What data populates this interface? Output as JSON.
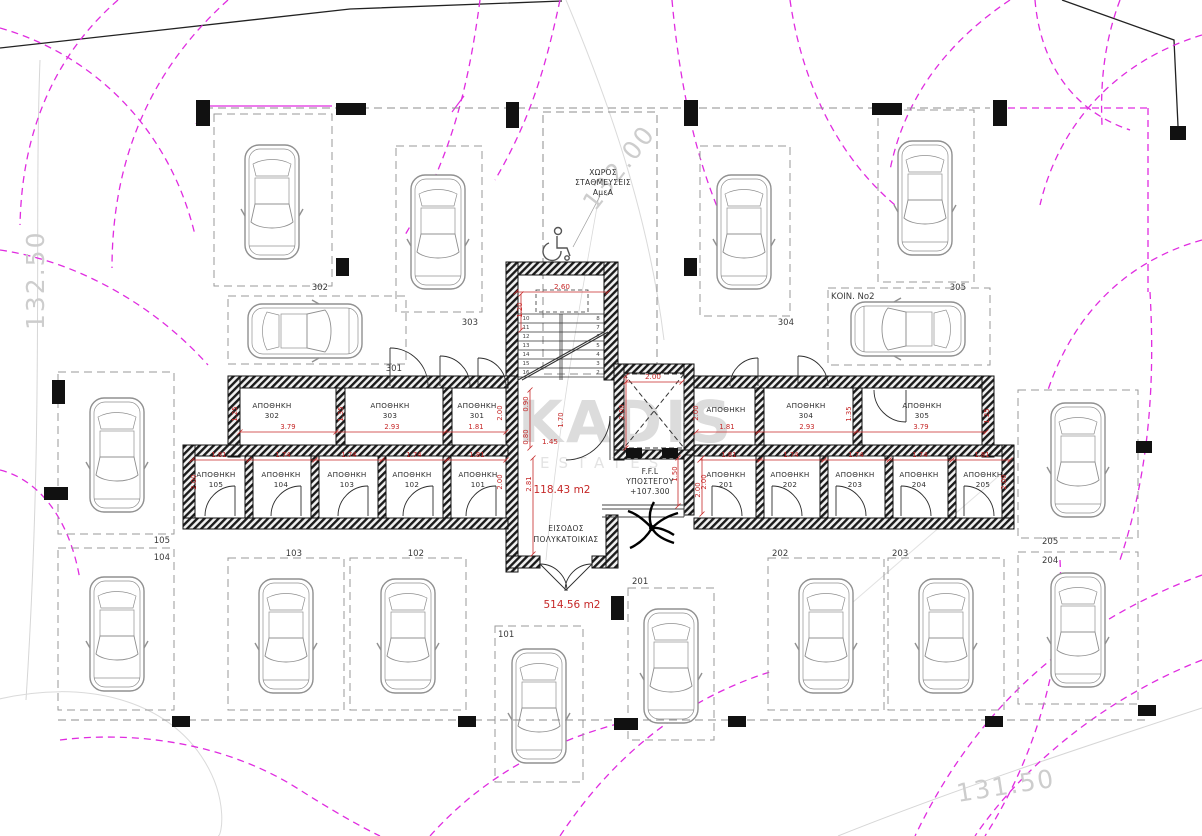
{
  "drawing": {
    "site_levels": [
      {
        "label": "132.50",
        "x": 44,
        "y": 330,
        "rot": -90
      },
      {
        "label": "132.00",
        "x": 595,
        "y": 212,
        "rot": -52
      },
      {
        "label": "131.50",
        "x": 958,
        "y": 802,
        "rot": -9
      }
    ],
    "watermark": {
      "brand": "KADIS",
      "sub": "ESTATES"
    },
    "amea": {
      "line1": "ΧΩΡΟΣ",
      "line2": "ΣΤΑΘΜΕΥΣΕΙΣ",
      "line3": "ΑμεΑ"
    },
    "ffl": {
      "line1": "F.F.L",
      "line2": "ΥΠΟΣΤΕΓΟΥ",
      "line3": "+107.300"
    },
    "areas": {
      "inner": "118.43 m2",
      "total": "514.56 m2"
    },
    "entrance": {
      "line1": "ΕΙΣΟΔΟΣ",
      "line2": "ΠΟΛΥΚΑΤΟΙΚΙΑΣ"
    },
    "koin_label": "ΚΟΙΝ. Νο2",
    "storage_rooms": [
      {
        "label": "ΑΠΟΘΗΚΗ",
        "number": "302",
        "x": 272,
        "y": 408
      },
      {
        "label": "ΑΠΟΘΗΚΗ",
        "number": "303",
        "x": 390,
        "y": 408
      },
      {
        "label": "ΑΠΟΘΗΚΗ",
        "number": "301",
        "x": 477,
        "y": 408
      },
      {
        "label": "ΑΠΟΘΗΚΗ",
        "number": "",
        "x": 726,
        "y": 412
      },
      {
        "label": "ΑΠΟΘΗΚΗ",
        "number": "304",
        "x": 806,
        "y": 408
      },
      {
        "label": "ΑΠΟΘΗΚΗ",
        "number": "305",
        "x": 922,
        "y": 408
      },
      {
        "label": "ΑΠΟΘΗΚΗ",
        "number": "105",
        "x": 216,
        "y": 477
      },
      {
        "label": "ΑΠΟΘΗΚΗ",
        "number": "104",
        "x": 281,
        "y": 477
      },
      {
        "label": "ΑΠΟΘΗΚΗ",
        "number": "103",
        "x": 347,
        "y": 477
      },
      {
        "label": "ΑΠΟΘΗΚΗ",
        "number": "102",
        "x": 412,
        "y": 477
      },
      {
        "label": "ΑΠΟΘΗΚΗ",
        "number": "101",
        "x": 478,
        "y": 477
      },
      {
        "label": "ΑΠΟΘΗΚΗ",
        "number": "201",
        "x": 726,
        "y": 477
      },
      {
        "label": "ΑΠΟΘΗΚΗ",
        "number": "202",
        "x": 790,
        "y": 477
      },
      {
        "label": "ΑΠΟΘΗΚΗ",
        "number": "203",
        "x": 855,
        "y": 477
      },
      {
        "label": "ΑΠΟΘΗΚΗ",
        "number": "204",
        "x": 919,
        "y": 477
      },
      {
        "label": "ΑΠΟΘΗΚΗ",
        "number": "205",
        "x": 983,
        "y": 477
      }
    ],
    "width_dims": [
      {
        "label": "3.79",
        "x": 288,
        "y": 429
      },
      {
        "label": "2.93",
        "x": 392,
        "y": 429
      },
      {
        "label": "1.81",
        "x": 476,
        "y": 429
      },
      {
        "label": "1.81",
        "x": 727,
        "y": 429
      },
      {
        "label": "2.93",
        "x": 807,
        "y": 429
      },
      {
        "label": "3.79",
        "x": 921,
        "y": 429
      },
      {
        "label": "1.81",
        "x": 219,
        "y": 457
      },
      {
        "label": "1.74",
        "x": 283,
        "y": 457
      },
      {
        "label": "1.74",
        "x": 349,
        "y": 457
      },
      {
        "label": "1.74",
        "x": 414,
        "y": 457
      },
      {
        "label": "1.81",
        "x": 477,
        "y": 457
      },
      {
        "label": "1.81",
        "x": 729,
        "y": 457
      },
      {
        "label": "1.74",
        "x": 791,
        "y": 457
      },
      {
        "label": "1.74",
        "x": 856,
        "y": 457
      },
      {
        "label": "1.74",
        "x": 920,
        "y": 457
      },
      {
        "label": "1.81",
        "x": 982,
        "y": 457
      }
    ],
    "vertical_dims": [
      {
        "label": "1.25",
        "x": 237,
        "y": 414
      },
      {
        "label": "1.35",
        "x": 343,
        "y": 414
      },
      {
        "label": "2.00",
        "x": 502,
        "y": 413
      },
      {
        "label": "2.00",
        "x": 698,
        "y": 413
      },
      {
        "label": "1.35",
        "x": 851,
        "y": 414
      },
      {
        "label": "1.25",
        "x": 989,
        "y": 416
      },
      {
        "label": "2.00",
        "x": 196,
        "y": 482
      },
      {
        "label": "2.00",
        "x": 502,
        "y": 482
      },
      {
        "label": "2.00",
        "x": 706,
        "y": 482
      },
      {
        "label": "2.00",
        "x": 1006,
        "y": 482
      },
      {
        "label": "2.81",
        "x": 531,
        "y": 484
      },
      {
        "label": "1.50",
        "x": 677,
        "y": 474
      },
      {
        "label": "2.00",
        "x": 700,
        "y": 490
      },
      {
        "label": "1.20",
        "x": 522,
        "y": 310
      },
      {
        "label": "2.00",
        "x": 624,
        "y": 412
      },
      {
        "label": "0.90",
        "x": 528,
        "y": 404
      },
      {
        "label": "0.80",
        "x": 528,
        "y": 437
      },
      {
        "label": "1.70",
        "x": 563,
        "y": 420
      }
    ],
    "small_dims": [
      {
        "label": "2.60",
        "x": 562,
        "y": 289
      },
      {
        "label": "2.00",
        "x": 653,
        "y": 379
      },
      {
        "label": "1.45",
        "x": 550,
        "y": 444
      }
    ],
    "stair": {
      "left_numbers": [
        "10",
        "11",
        "12",
        "13",
        "14",
        "15",
        "16"
      ],
      "right_numbers": [
        "8",
        "7",
        "6",
        "5",
        "4",
        "3",
        "2"
      ]
    },
    "parking_bays": [
      {
        "number": "302",
        "x": 214,
        "y": 114,
        "w": 118,
        "h": 172,
        "lx": 328,
        "ly": 290,
        "anchor": "end",
        "car": {
          "cx": 272,
          "cy": 202,
          "rot": 180
        }
      },
      {
        "number": "303",
        "x": 396,
        "y": 146,
        "w": 86,
        "h": 166,
        "lx": 478,
        "ly": 325,
        "anchor": "end",
        "car": {
          "cx": 438,
          "cy": 232,
          "rot": 180
        }
      },
      {
        "number": "301",
        "x": 228,
        "y": 296,
        "w": 178,
        "h": 68,
        "lx": 402,
        "ly": 371,
        "anchor": "end",
        "car": {
          "cx": 305,
          "cy": 331,
          "rot": 90
        }
      },
      {
        "number": "304",
        "x": 700,
        "y": 146,
        "w": 90,
        "h": 170,
        "lx": 794,
        "ly": 325,
        "anchor": "end",
        "car": {
          "cx": 744,
          "cy": 232,
          "rot": 180
        }
      },
      {
        "number": "305",
        "x": 878,
        "y": 110,
        "w": 96,
        "h": 172,
        "lx": 966,
        "ly": 290,
        "anchor": "end",
        "car": {
          "cx": 925,
          "cy": 198,
          "rot": 180
        }
      },
      {
        "number": "",
        "x": 828,
        "y": 288,
        "w": 162,
        "h": 77,
        "lx": 0,
        "ly": 0,
        "anchor": "start",
        "car": {
          "cx": 908,
          "cy": 329,
          "rot": -90
        }
      },
      {
        "number": "105",
        "x": 58,
        "y": 372,
        "w": 116,
        "h": 162,
        "lx": 170,
        "ly": 543,
        "anchor": "end",
        "car": {
          "cx": 117,
          "cy": 455,
          "rot": 180
        }
      },
      {
        "number": "104",
        "x": 58,
        "y": 548,
        "w": 116,
        "h": 162,
        "lx": 170,
        "ly": 560,
        "anchor": "end",
        "car": {
          "cx": 117,
          "cy": 634,
          "rot": 180
        }
      },
      {
        "number": "103",
        "x": 228,
        "y": 558,
        "w": 116,
        "h": 152,
        "lx": 302,
        "ly": 556,
        "anchor": "end",
        "car": {
          "cx": 286,
          "cy": 636,
          "rot": 180
        }
      },
      {
        "number": "102",
        "x": 350,
        "y": 558,
        "w": 116,
        "h": 152,
        "lx": 424,
        "ly": 556,
        "anchor": "end",
        "car": {
          "cx": 408,
          "cy": 636,
          "rot": 180
        }
      },
      {
        "number": "101",
        "x": 495,
        "y": 626,
        "w": 88,
        "h": 156,
        "lx": 498,
        "ly": 637,
        "anchor": "start",
        "car": {
          "cx": 539,
          "cy": 706,
          "rot": 180
        }
      },
      {
        "number": "201",
        "x": 628,
        "y": 588,
        "w": 86,
        "h": 152,
        "lx": 632,
        "ly": 584,
        "anchor": "start",
        "car": {
          "cx": 671,
          "cy": 666,
          "rot": 180
        }
      },
      {
        "number": "202",
        "x": 768,
        "y": 558,
        "w": 116,
        "h": 152,
        "lx": 772,
        "ly": 556,
        "anchor": "start",
        "car": {
          "cx": 826,
          "cy": 636,
          "rot": 180
        }
      },
      {
        "number": "203",
        "x": 888,
        "y": 558,
        "w": 116,
        "h": 152,
        "lx": 892,
        "ly": 556,
        "anchor": "start",
        "car": {
          "cx": 946,
          "cy": 636,
          "rot": 180
        }
      },
      {
        "number": "205",
        "x": 1018,
        "y": 390,
        "w": 120,
        "h": 148,
        "lx": 1042,
        "ly": 544,
        "anchor": "start",
        "car": {
          "cx": 1078,
          "cy": 460,
          "rot": 180
        }
      },
      {
        "number": "204",
        "x": 1018,
        "y": 552,
        "w": 120,
        "h": 152,
        "lx": 1042,
        "ly": 563,
        "anchor": "start",
        "car": {
          "cx": 1078,
          "cy": 630,
          "rot": 180
        }
      }
    ]
  },
  "colors": {
    "dimension_red": "#c62828",
    "turning_magenta": "#e02ce0",
    "level_gray": "#cdcdcd",
    "line_gray": "#9a9a9a",
    "wall_black": "#1b1b1b",
    "watermark_gray": "#dcdcdc"
  }
}
